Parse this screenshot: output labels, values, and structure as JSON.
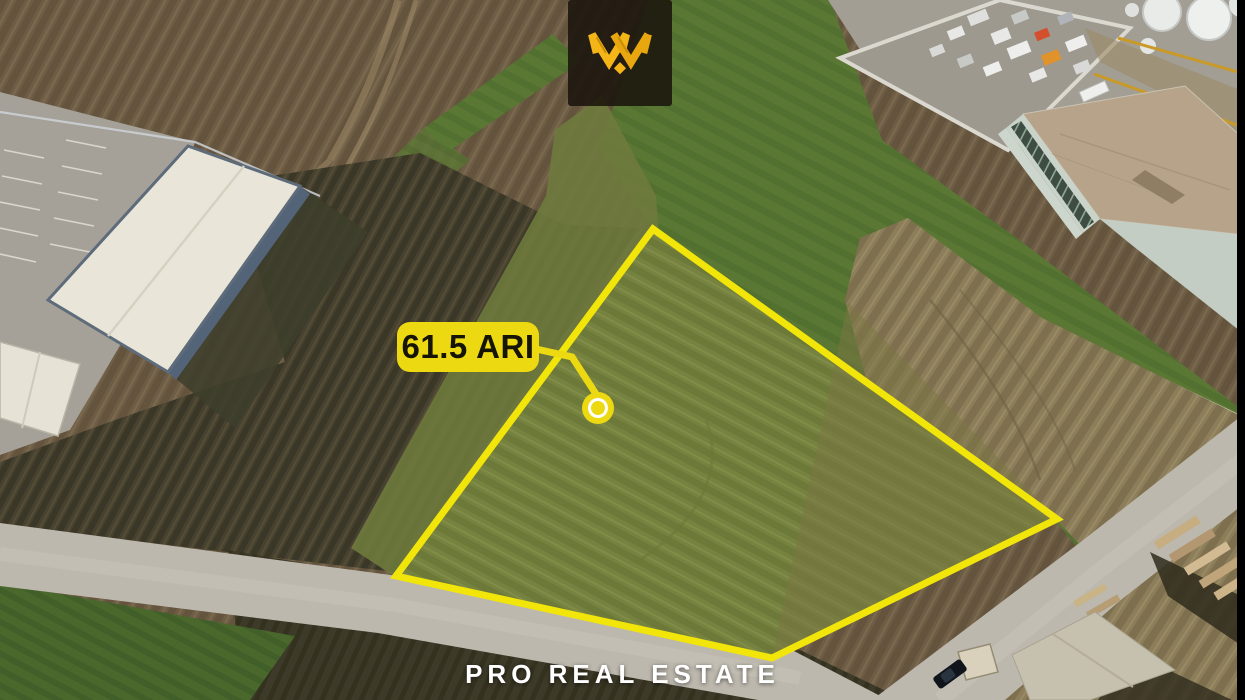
{
  "annotation": {
    "area_label": "61.5 ARI",
    "marker": "parcel-location-dot",
    "callout_color": "#ECD912",
    "callout_text_color": "#161402"
  },
  "brand": {
    "name": "PRO REAL ESTATE",
    "logo_emblem": "gold-monogram-w-diamond",
    "logo_background": "#1A150C",
    "logo_gold": "#F3B517"
  },
  "parcel": {
    "outline_color": "#F2E50A",
    "area_text": "61.5 ARI"
  }
}
